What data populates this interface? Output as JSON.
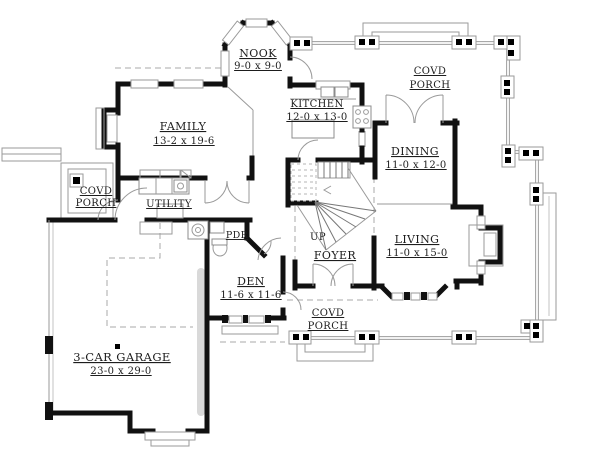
{
  "plan": {
    "rooms": {
      "nook": {
        "name": "NOOK",
        "dims": "9-0 x 9-0"
      },
      "kitchen": {
        "name": "KITCHEN",
        "dims": "12-0 x 13-0"
      },
      "family": {
        "name": "FAMILY",
        "dims": "13-2 x 19-6"
      },
      "dining": {
        "name": "DINING",
        "dims": "11-0 x 12-0"
      },
      "living": {
        "name": "LIVING",
        "dims": "11-0 x 15-0"
      },
      "den": {
        "name": "DEN",
        "dims": "11-6 x 11-6"
      },
      "garage": {
        "name": "3-CAR GARAGE",
        "dims": "23-0 x 29-0"
      },
      "utility": {
        "name": "UTILITY"
      },
      "pdr": {
        "name": "PDR"
      },
      "foyer": {
        "name": "FOYER"
      }
    },
    "porches": {
      "top": {
        "line1": "COVD",
        "line2": "PORCH"
      },
      "left": {
        "line1": "COVD",
        "line2": "PORCH"
      },
      "bottom": {
        "line1": "COVD",
        "line2": "PORCH"
      }
    },
    "stairs": {
      "up_label": "UP"
    },
    "colors": {
      "wall": "#111111",
      "thin_line": "#9a9a9a",
      "text": "#1d1d1d",
      "background": "#ffffff"
    }
  }
}
